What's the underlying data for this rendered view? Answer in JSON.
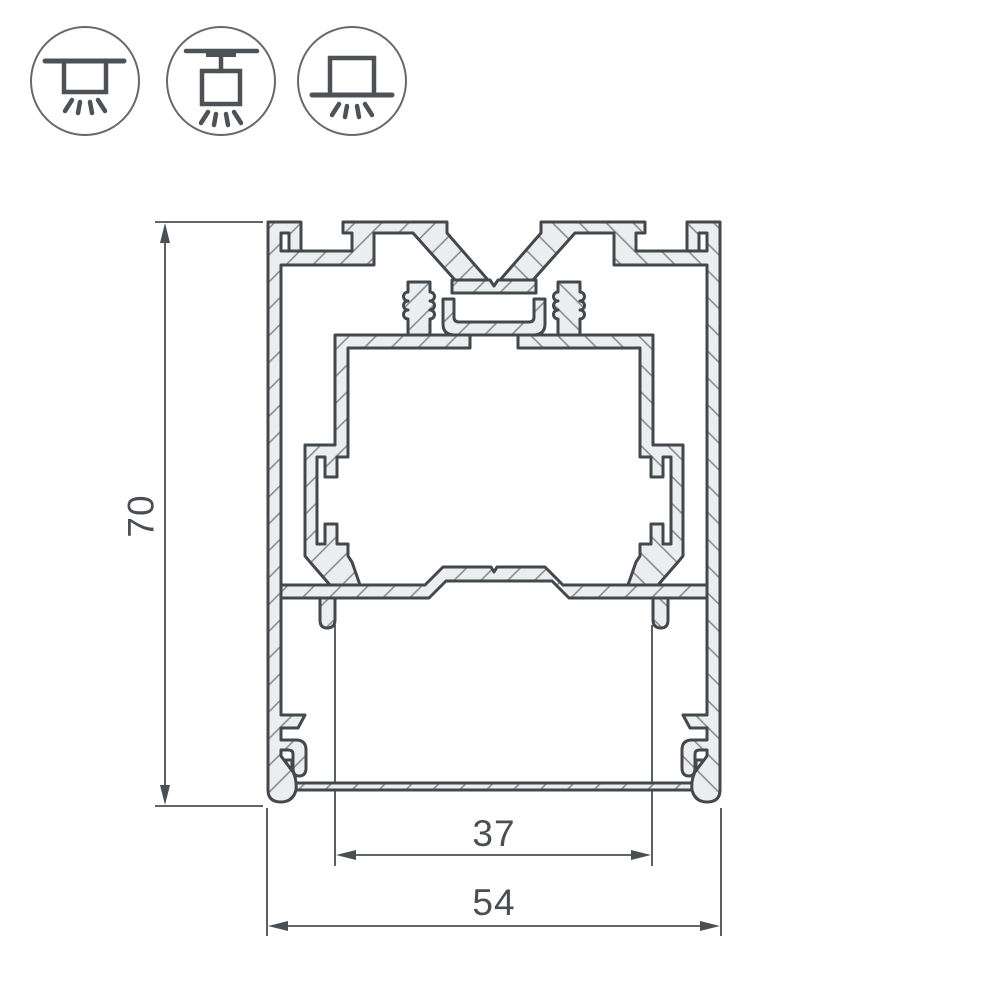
{
  "page": {
    "background": "#ffffff",
    "kind": "technical cross-section drawing of aluminum LED profile"
  },
  "mount_icons": {
    "items": [
      {
        "name": "ceiling-surface-mount-icon"
      },
      {
        "name": "pendant-suspension-mount-icon"
      },
      {
        "name": "base-surface-mount-icon"
      }
    ]
  },
  "drawing": {
    "units": "mm",
    "dimensions": {
      "height": {
        "label": "70"
      },
      "window_width": {
        "label": "37"
      },
      "overall_width": {
        "label": "54"
      }
    },
    "colors": {
      "outline": "#43484d",
      "material_fill": "#ecedee",
      "hatch": "#82878c",
      "dimension_lines": "#4a4f54",
      "icon_stroke": "#4d5257",
      "icon_circle": "#65696e"
    }
  }
}
